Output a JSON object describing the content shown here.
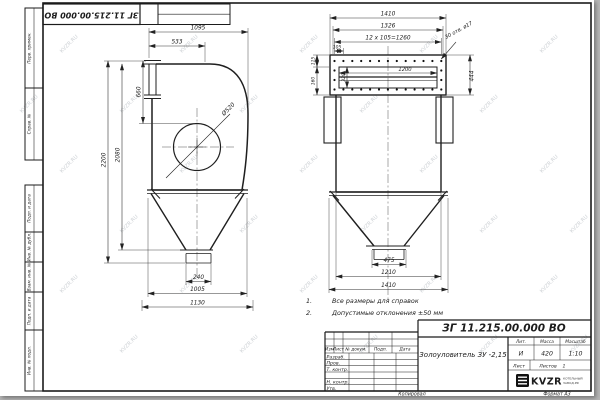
{
  "watermark": {
    "text": "KVZR.RU"
  },
  "stamp_top": {
    "doc_number": "ЗГ 11.215.00.000 ВО"
  },
  "margin": [
    "Перв. примен.",
    "Справ. №",
    "Подп. и дата",
    "Инв. № дубл.",
    "Взам. инв. №",
    "Подп. и дата",
    "Инв. № подл."
  ],
  "notes": [
    {
      "num": "1.",
      "text": "Все размеры для справок"
    },
    {
      "num": "2.",
      "text": "Допустимые отклонения  ±50 мм"
    }
  ],
  "side_dims": {
    "w1095": "1095",
    "w533": "533",
    "h660": "660",
    "h2200": "2200",
    "h2080": "2080",
    "d520": "Ø520",
    "b240": "240",
    "b1005": "1005",
    "b1130": "1130"
  },
  "front_dims": {
    "t1410": "1410",
    "t1326": "1326",
    "t1260": "12 x 105=1260",
    "t105": "105",
    "holes": "30 отв. ø17",
    "h444": "444",
    "w1200": "1200",
    "l115": "115",
    "l160": "160",
    "i320": "320",
    "b475": "475",
    "b1210": "1210",
    "b1410": "1410"
  },
  "title_block": {
    "doc_number": "ЗГ 11.215.00.000  ВО",
    "name": "Золоуловитель  ЗУ -2,15",
    "header_cols": [
      "Изм",
      "Лист",
      "№ докум.",
      "Подп.",
      "Дата"
    ],
    "rows": [
      "Разраб.",
      "Пров.",
      "Т. контр.",
      "",
      "Н. контр.",
      "Утв."
    ],
    "lit_label": "Лит.",
    "mass_label": "Масса",
    "scale_label": "Масштаб",
    "lit_value": "И",
    "mass_value": "420",
    "scale_value": "1:10",
    "sheet_label": "Лист",
    "sheets_label": "Листов",
    "sheets_value": "1",
    "logo_text": "KVZR",
    "logo_sub1": "КОТЕЛЬНЫЙ",
    "logo_sub2": "ЗАВОД.РФ"
  },
  "footer": {
    "copied": "Копировал",
    "format": "Формат А3"
  }
}
